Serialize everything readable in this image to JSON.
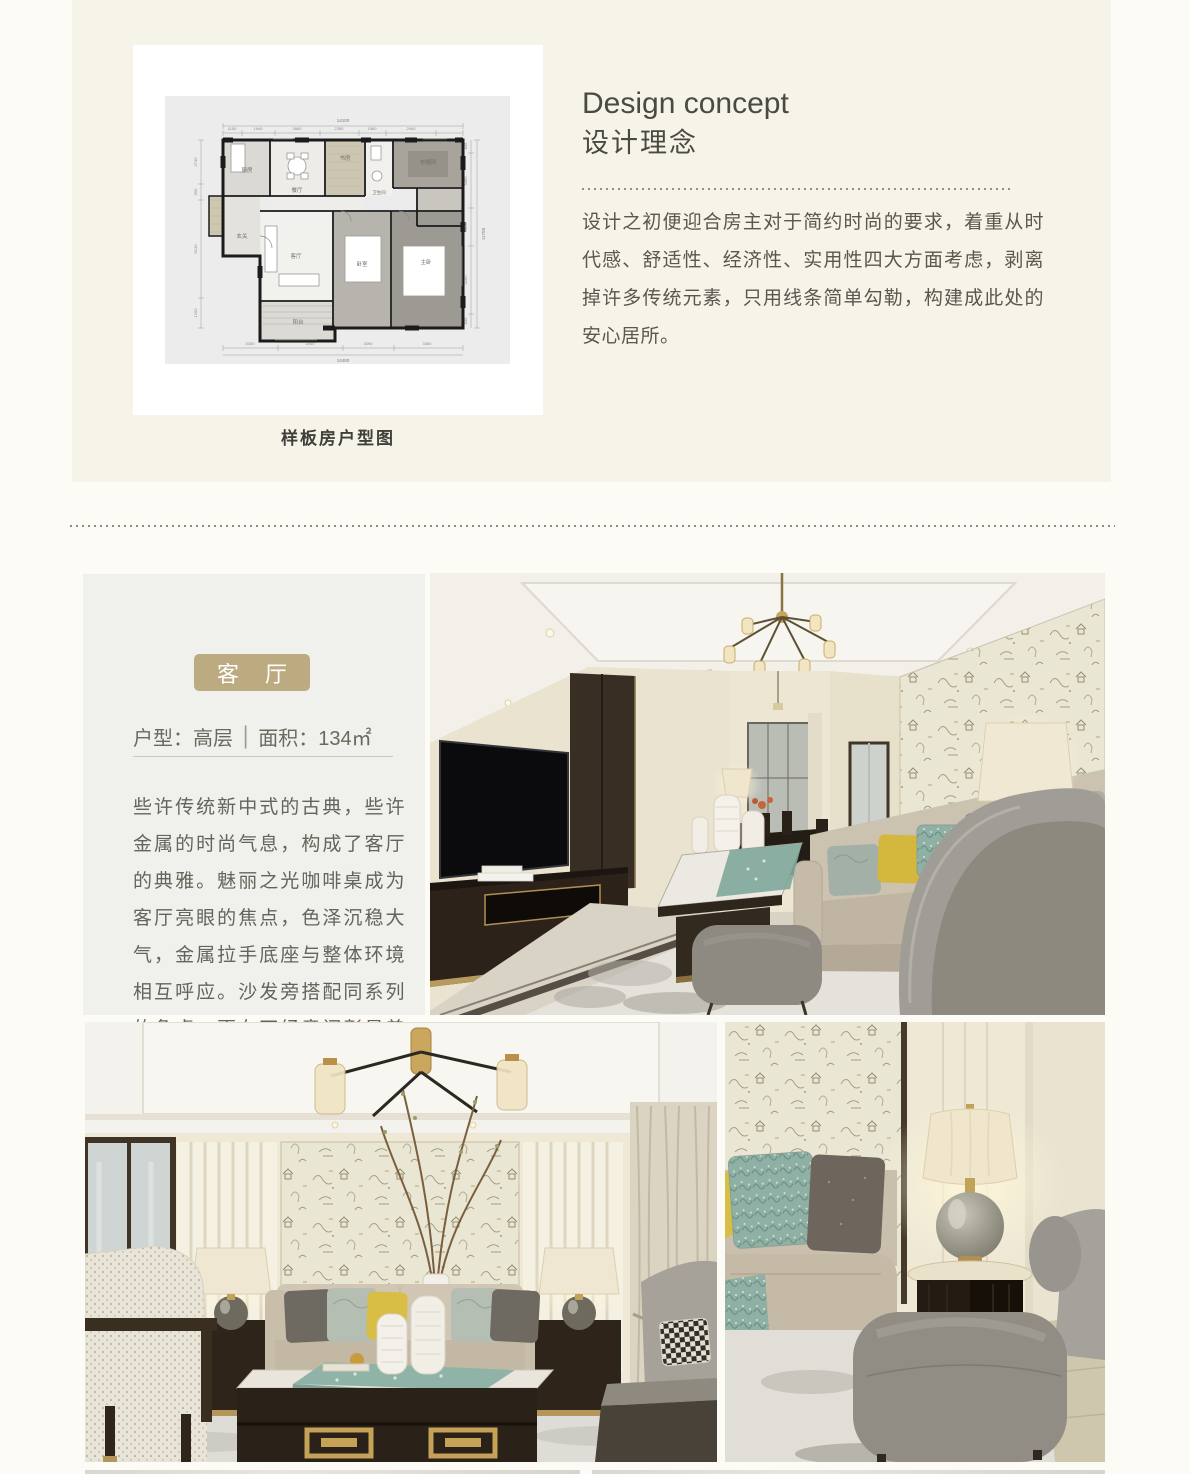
{
  "page": {
    "background": "#fcfbf5"
  },
  "hero": {
    "background": "#f6f3e9",
    "floorplan": {
      "caption": "样板房户型图",
      "rooms": [
        "厨房",
        "餐厅",
        "书房",
        "卫生间",
        "衣帽间",
        "玄关",
        "客厅",
        "卧室",
        "主卧",
        "阳台"
      ],
      "dims": {
        "top_total": "14100",
        "top_segments": [
          "1100",
          "1940",
          "2660",
          "2280",
          "1560",
          "2940"
        ],
        "bottom_total": "14480",
        "bottom_segments": [
          "3330",
          "3940",
          "3090",
          "3360"
        ],
        "right_total": "11750",
        "right_segments": [
          "840",
          "3460",
          "2350",
          "4260",
          "840"
        ],
        "left_segments": [
          "2740",
          "990",
          "6130",
          "1200"
        ]
      }
    },
    "concept": {
      "title_en": "Design concept",
      "title_zh": "设计理念",
      "body": "设计之初便迎合房主对于简约时尚的要求，着重从时代感、舒适性、经济性、实用性四大方面考虑，剥离掉许多传统元素，只用线条简单勾勒，构建成此处的安心居所。"
    }
  },
  "living": {
    "badge": "客 厅",
    "badge_color": "#bcaa80",
    "meta": {
      "left": "户型：高层",
      "divider": "|",
      "right": "面积：134㎡"
    },
    "body": "些许传统新中式的古典，些许金属的时尚气息，构成了客厅的典雅。魅丽之光咖啡桌成为客厅亮眼的焦点，色泽沉稳大气，金属拉手底座与整体环境相互呼应。沙发旁搭配同系列的角桌，更在不经意间彰显着低调时尚的格调。"
  },
  "colors": {
    "accent_gold": "#bcaa80",
    "hero_cream": "#f6f3e9",
    "panel_gray": "#f0f1ed",
    "heading": "#4b4a41",
    "body_text": "#5a584e"
  }
}
